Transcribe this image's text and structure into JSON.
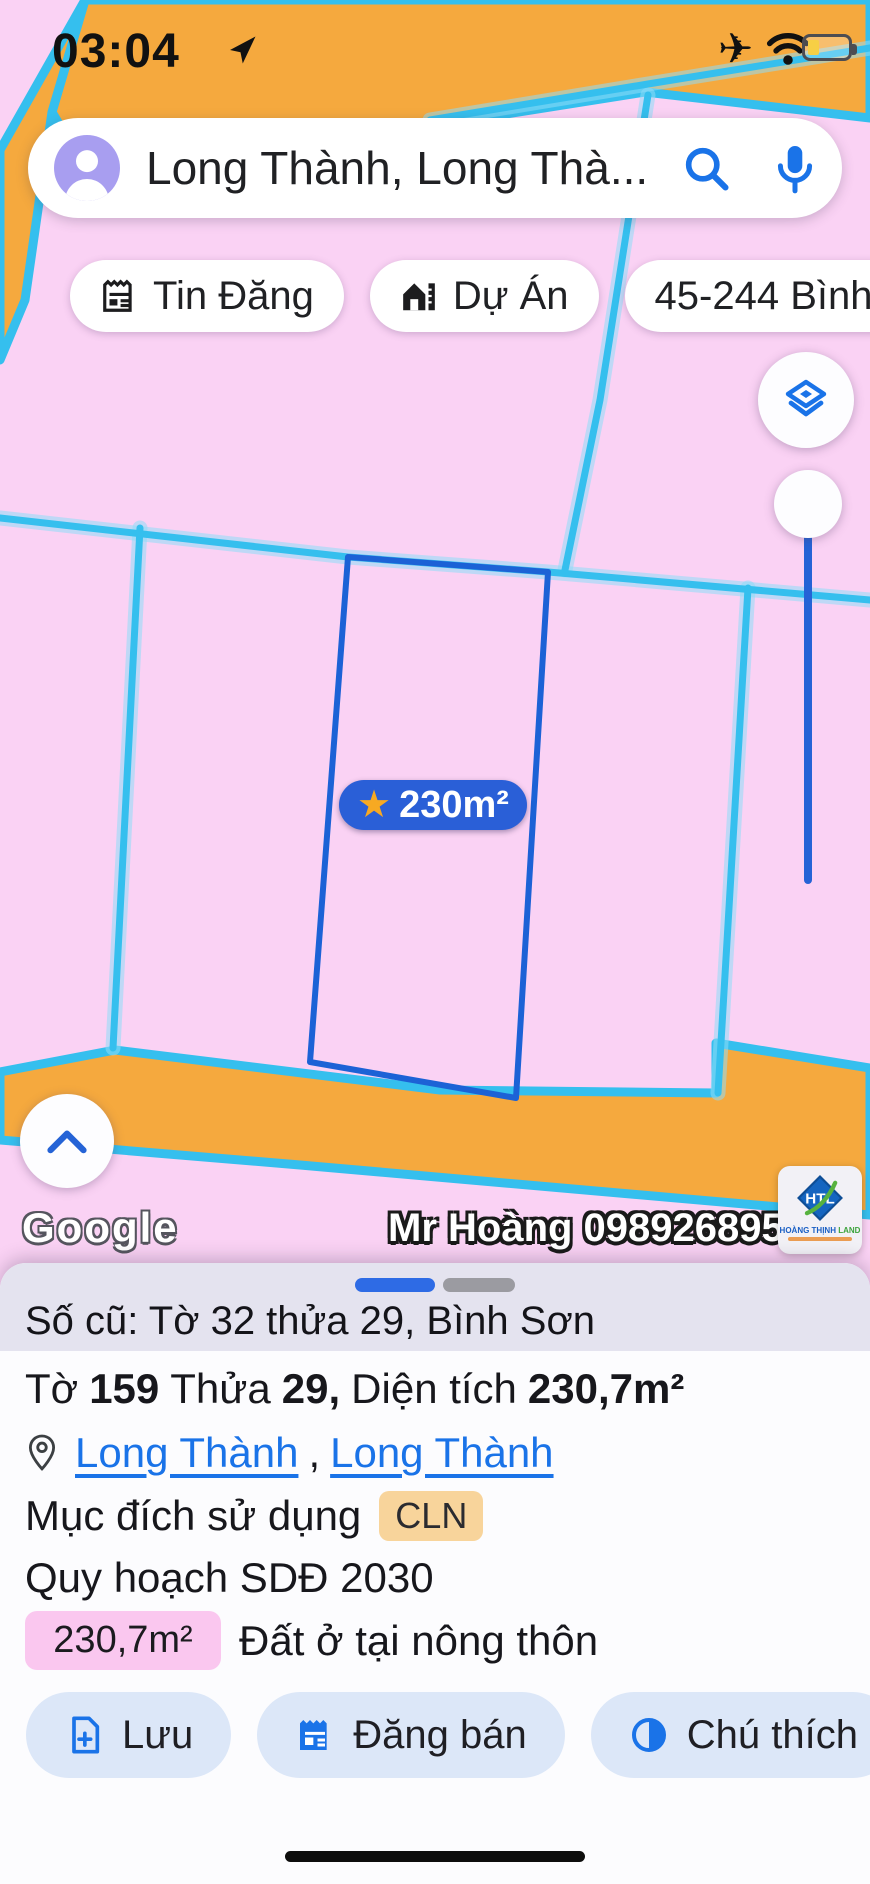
{
  "status_bar": {
    "time": "03:04"
  },
  "icons": {
    "airplane": "✈",
    "star": "★"
  },
  "search": {
    "query": "Long Thành, Long Thà..."
  },
  "chips": [
    {
      "label": "Tin Đăng"
    },
    {
      "label": "Dự Án"
    },
    {
      "label": "45-244 Bình Sơn"
    }
  ],
  "map": {
    "parcel_label": "230m²",
    "google_watermark": "Google",
    "agent_watermark": "Mr Hoàng 0989268955",
    "logo": {
      "monogram": "HTL",
      "name_blue": "HOÀNG THỊNH",
      "name_green": " LAND"
    }
  },
  "sheet": {
    "old_ref": "Số cũ: Tờ 32 thửa 29, Bình Sơn",
    "parcel": {
      "t1": "Tờ",
      "v1": "159",
      "t2": "Thửa",
      "v2": "29,",
      "t3": "Diện tích",
      "v3": "230,7m²"
    },
    "location": {
      "link1": "Long Thành",
      "separator": ",",
      "link2": "Long Thành"
    },
    "purpose_label": "Mục đích sử dụng",
    "purpose_value": "CLN",
    "planning": "Quy hoạch SDĐ 2030",
    "area_badge": "230,7m²",
    "area_desc": "Đất ở tại nông thôn",
    "buttons": [
      {
        "label": "Lưu"
      },
      {
        "label": "Đăng bán"
      },
      {
        "label": "Chú thích"
      }
    ]
  },
  "colors": {
    "pink": "#fad2f4",
    "cyan": "#35bfee",
    "orange": "#f5a93e",
    "parcel_stroke": "#1c62d6",
    "label_bg": "#2a5fd7",
    "link_blue": "#1a73e8",
    "purpose_bg": "#f8d49b",
    "area_bg": "#fac7ef",
    "button_bg": "#dce7f8",
    "row_bg": "#e4e3ef"
  }
}
